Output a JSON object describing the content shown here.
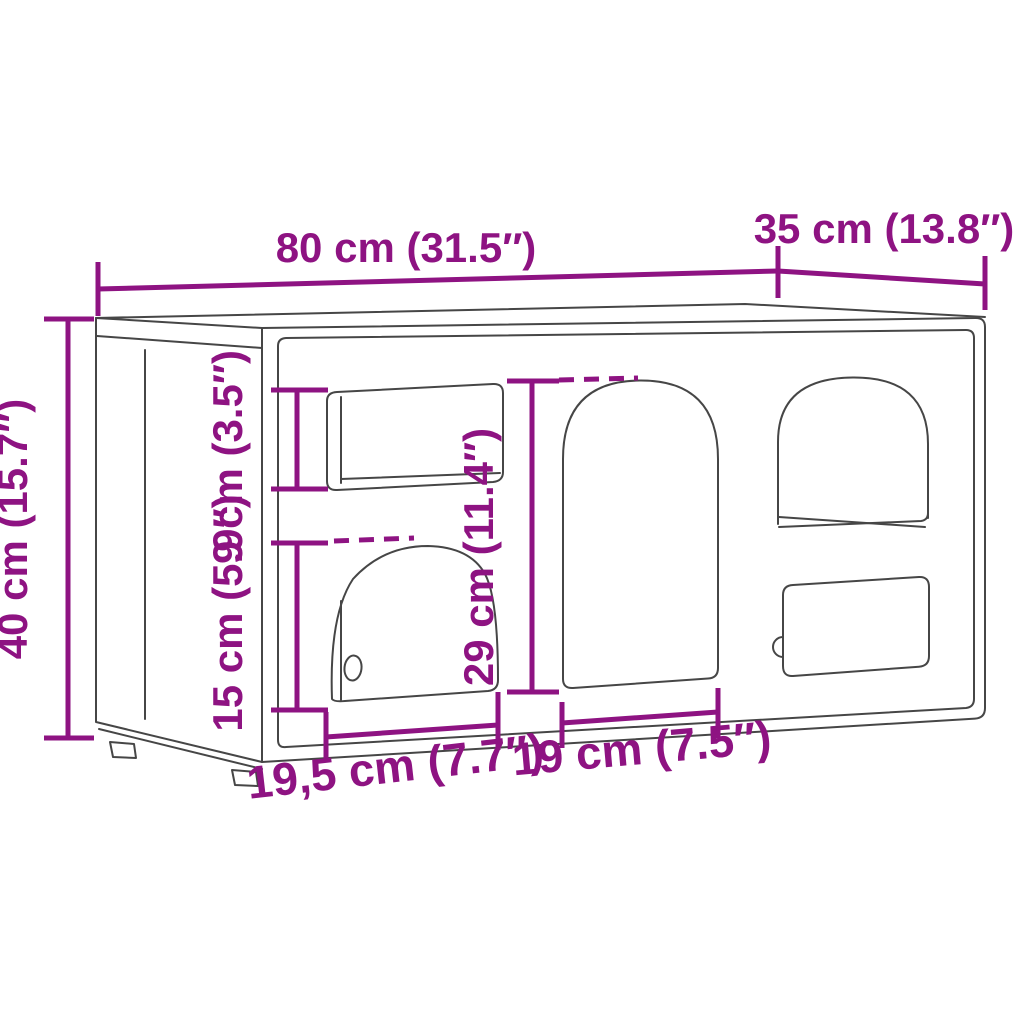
{
  "figure": {
    "kind": "product-dimension-diagram",
    "background_color": "#FFFFFF",
    "outline_color": "#464646",
    "dimension_color": "#8E1382"
  },
  "dimensions": {
    "overall_width": "80 cm (31.5″)",
    "overall_depth": "35 cm (13.8″)",
    "overall_height": "40 cm (15.7″)",
    "top_opening_height": "9 cm (3.5″)",
    "lower_opening_height": "15 cm (5.9″)",
    "arch_opening_height": "29 cm (11.4″)",
    "left_opening_width": "19,5 cm (7.7″)",
    "middle_opening_width": "19 cm (7.5″)"
  }
}
